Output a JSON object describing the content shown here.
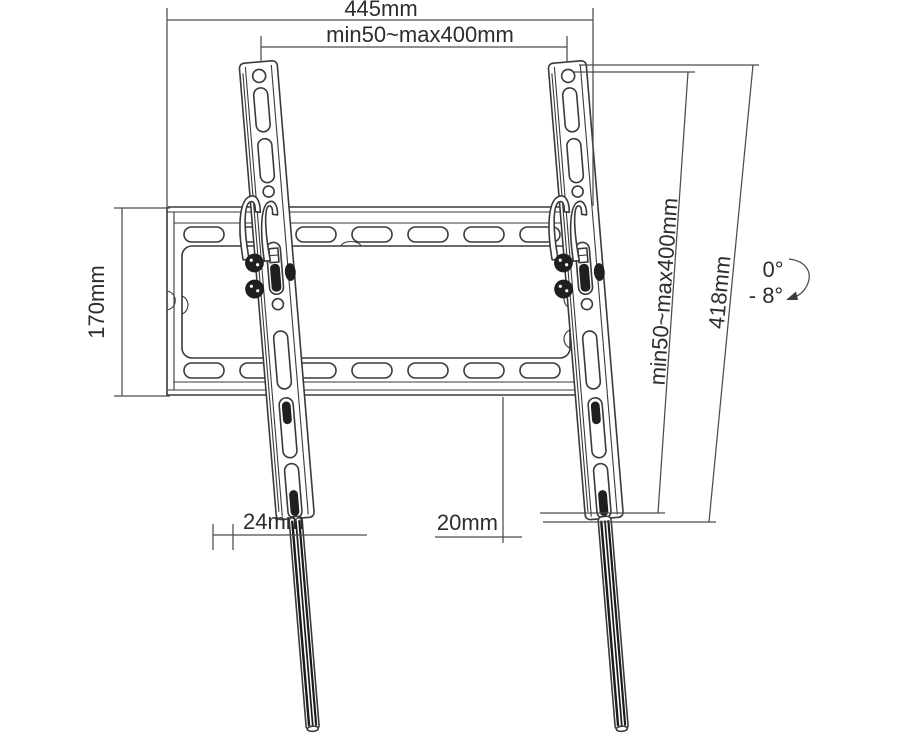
{
  "title": "Tilting TV wall mount bracket — dimensional line drawing",
  "colors": {
    "line": "#3a3a3a",
    "dimension_line": "#4c4c4c",
    "text": "#2d2d2d",
    "dark_fill": "#1f1f1f",
    "background": "#ffffff"
  },
  "labels": {
    "overall_width": "445mm",
    "vesa_width": "min50~max400mm",
    "plate_height": "170mm",
    "vesa_height": "min50~max400mm",
    "bracket_length": "418mm",
    "offset_left": "24mm",
    "offset_right": "20mm",
    "tilt_upper": "0°",
    "tilt_lower": "- 8°"
  }
}
